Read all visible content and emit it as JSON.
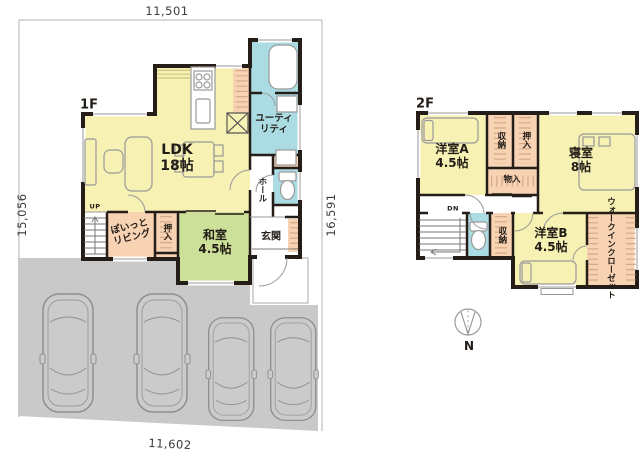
{
  "dimensions": {
    "top": "11,501",
    "left": "15,056",
    "right": "16,591",
    "bottom": "11,602"
  },
  "floor1": {
    "floor_label": "1F",
    "ldk_name": "LDK",
    "ldk_size": "18帖",
    "washitsu_name": "和室",
    "washitsu_size": "4.5帖",
    "poitto_line1": "ぽいっと",
    "poitto_line2": "リビング",
    "oshiire": "押入",
    "utility_line1": "ユーティ",
    "utility_line2": "リティ",
    "hall": "ホール",
    "genkan": "玄関",
    "stairs_up": "UP"
  },
  "floor2": {
    "floor_label": "2F",
    "roomA_name": "洋室A",
    "roomA_size": "4.5帖",
    "bedroom_name": "寝室",
    "bedroom_size": "8帖",
    "roomB_name": "洋室B",
    "roomB_size": "4.5帖",
    "closet_top1": "収納",
    "closet_top2": "押入",
    "closet_mono": "物入",
    "closet_low": "収納",
    "wic_line1": "ウォークイン",
    "wic_line2": "クローゼット",
    "stairs_down": "DN"
  },
  "compass": {
    "north": "N"
  },
  "colors": {
    "wall": "#251e18",
    "room_yellow": "#f7f2b4",
    "room_green": "#cde09a",
    "room_blue": "#abdbe3",
    "room_peach": "#f7d2b3",
    "parking_gray": "#c9c9c9",
    "dimension_line": "#b3b3b3",
    "label_text": "#221c16"
  }
}
